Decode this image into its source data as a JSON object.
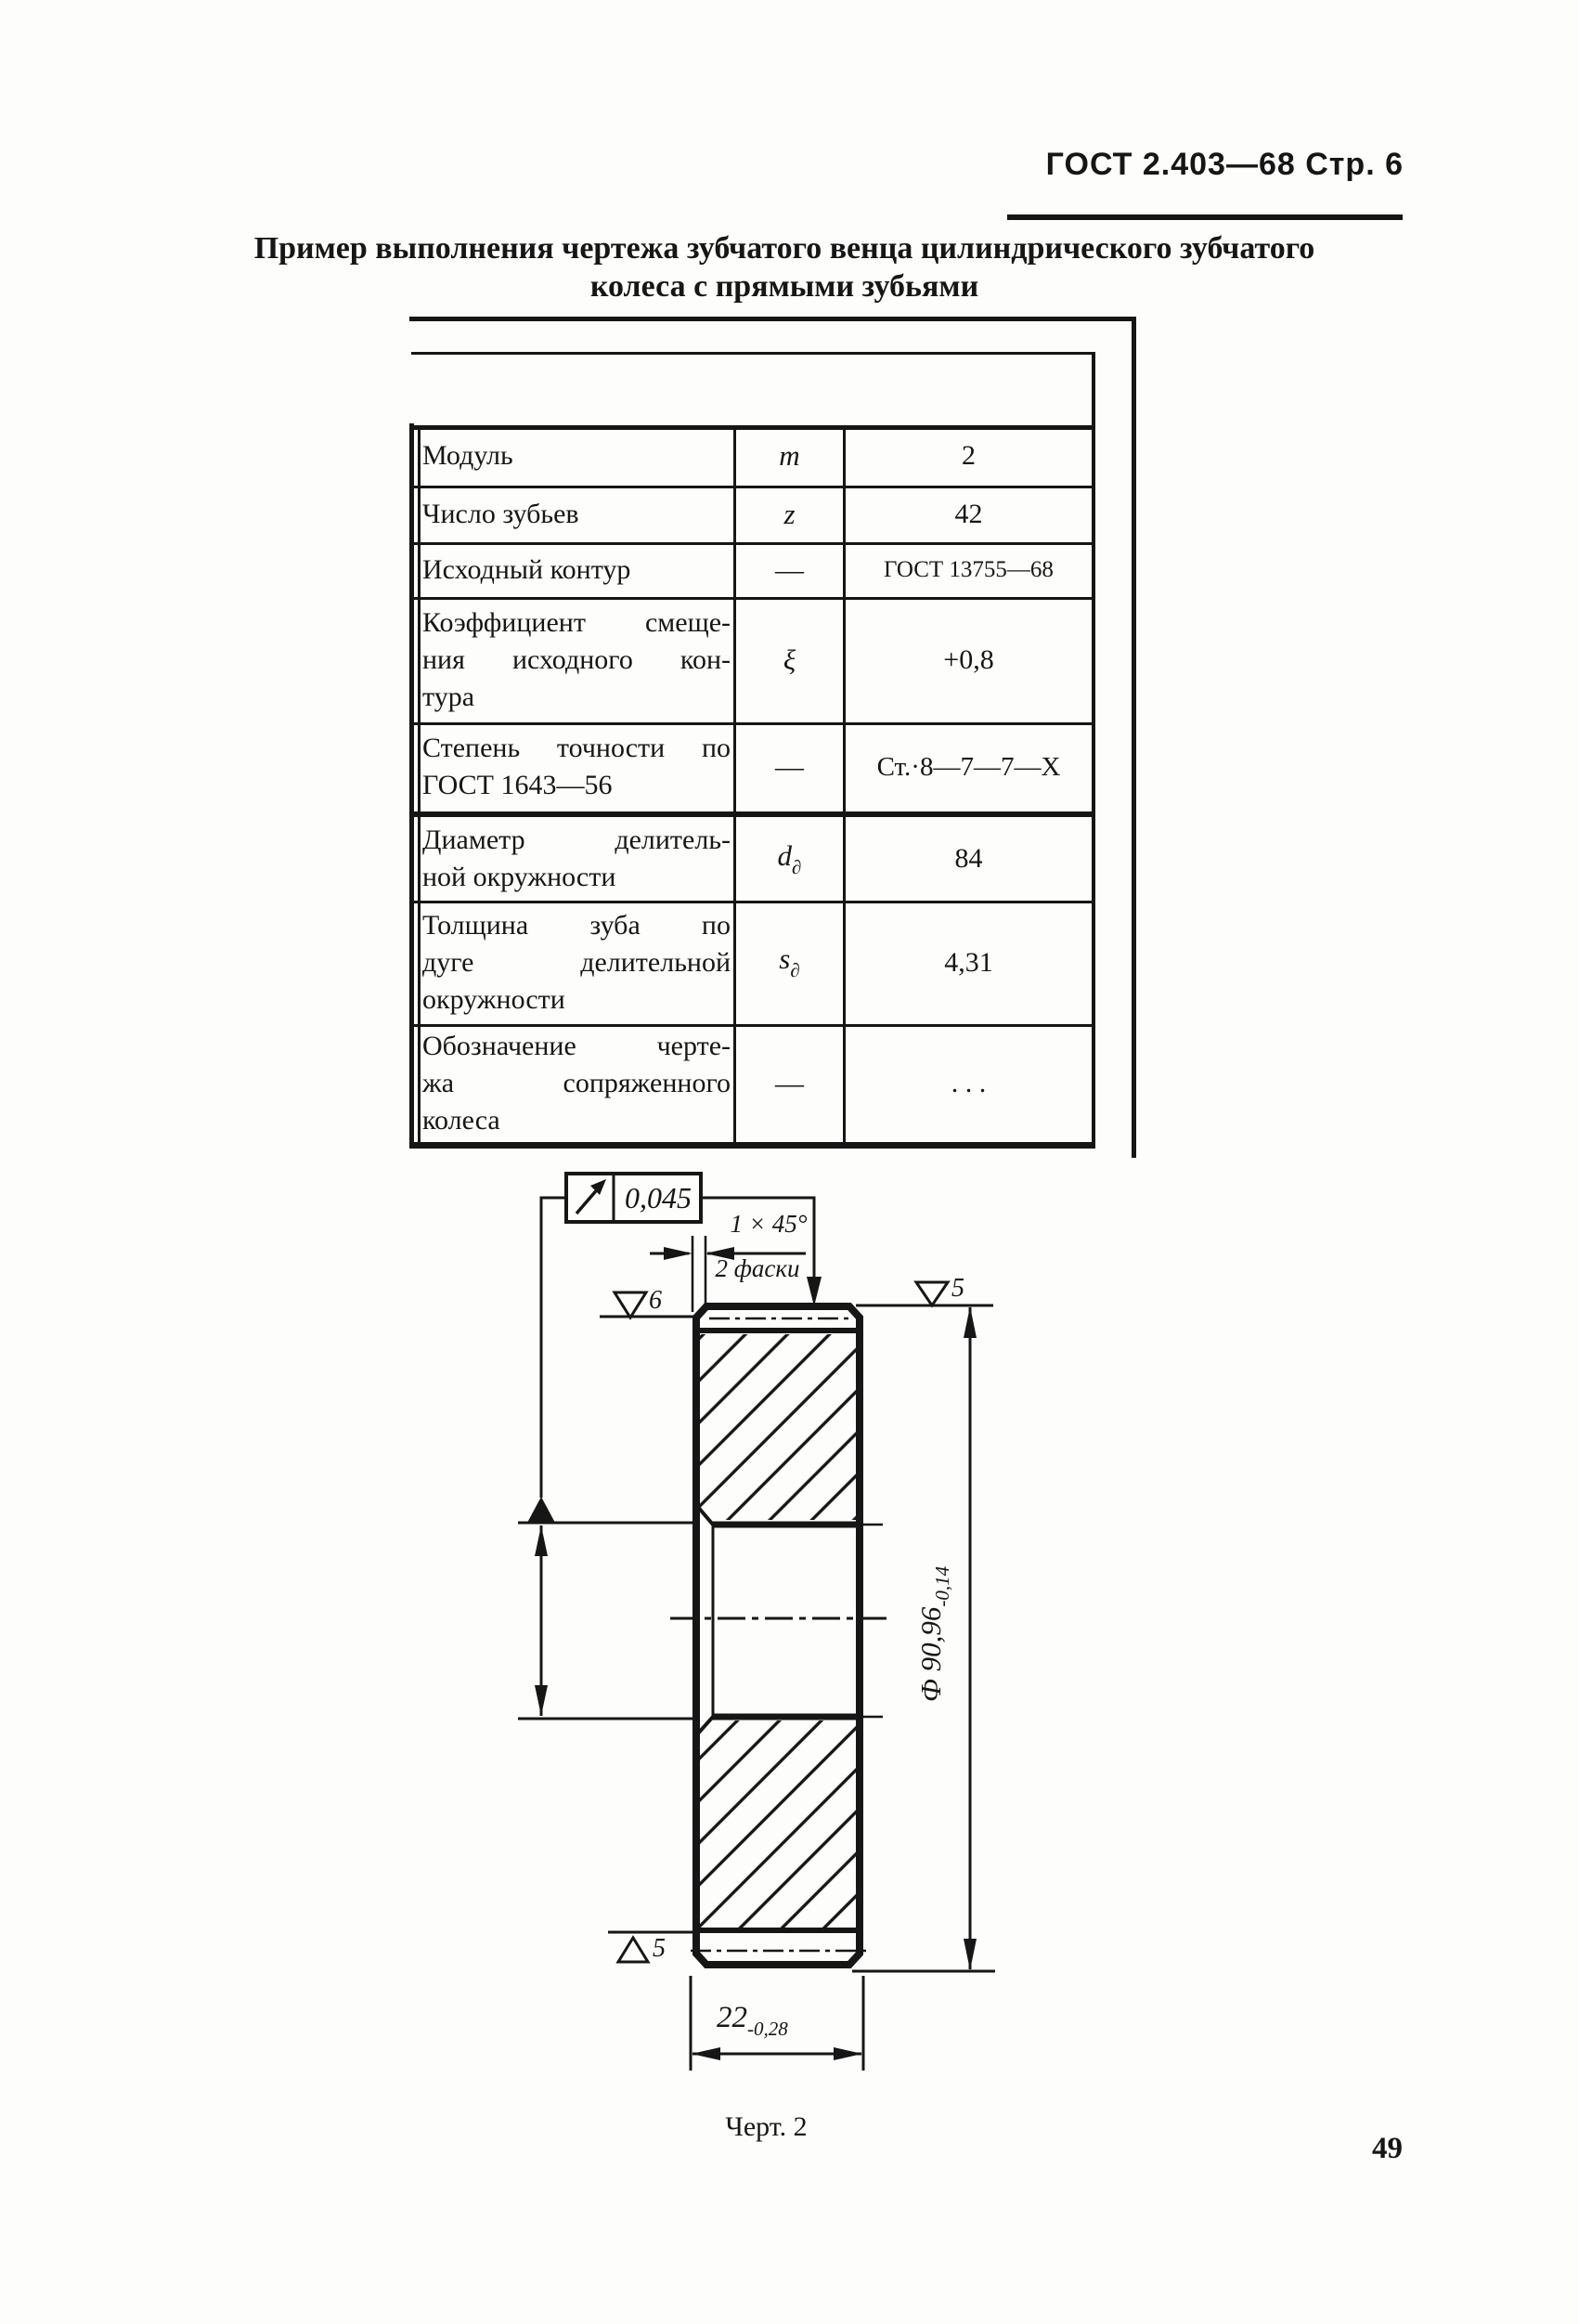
{
  "page": {
    "header": "ГОСТ 2.403—68 Стр. 6",
    "title_line1": "Пример выполнения чертежа зубчатого венца цилиндрического зубчатого",
    "title_line2": "колеса с прямыми зубьями",
    "figure_caption": "Черт. 2",
    "page_number": "49"
  },
  "table": {
    "rows": [
      {
        "name_lines": [
          "Модуль"
        ],
        "symbol": "m",
        "value": "2"
      },
      {
        "name_lines": [
          "Число зубьев"
        ],
        "symbol": "z",
        "value": "42"
      },
      {
        "name_lines": [
          "Исходный контур"
        ],
        "symbol": "—",
        "value": "ГОСТ 13755—68"
      },
      {
        "name_lines": [
          "Коэффициент смеще-",
          "ния исходного кон-",
          "тура"
        ],
        "symbol": "ξ",
        "value": "+0,8"
      },
      {
        "name_lines": [
          "Степень точности по",
          "ГОСТ 1643—56"
        ],
        "symbol": "—",
        "value": "Ст.·8—7—7—Х"
      },
      {
        "name_lines": [
          "Диаметр делитель-",
          "ной окружности"
        ],
        "symbol": "d",
        "symbol_sub": "∂",
        "value": "84"
      },
      {
        "name_lines": [
          "Толщина зуба по",
          "дуге делительной",
          "окружности"
        ],
        "symbol": "s",
        "symbol_sub": "∂",
        "value": "4,31"
      },
      {
        "name_lines": [
          "Обозначение черте-",
          "жа сопряженного",
          "колеса"
        ],
        "symbol": "—",
        "value": ". . ."
      }
    ]
  },
  "drawing": {
    "tolerance_value": "0,045",
    "chamfer_dim": "1 × 45°",
    "chamfer_note": "2 фаски",
    "surface_finish_left": "6",
    "surface_finish_right": "5",
    "surface_finish_bottom": "5",
    "diameter_value": "Ф 90,96",
    "diameter_tolerance": "-0,14",
    "width_value": "22",
    "width_tolerance": "-0,28"
  }
}
